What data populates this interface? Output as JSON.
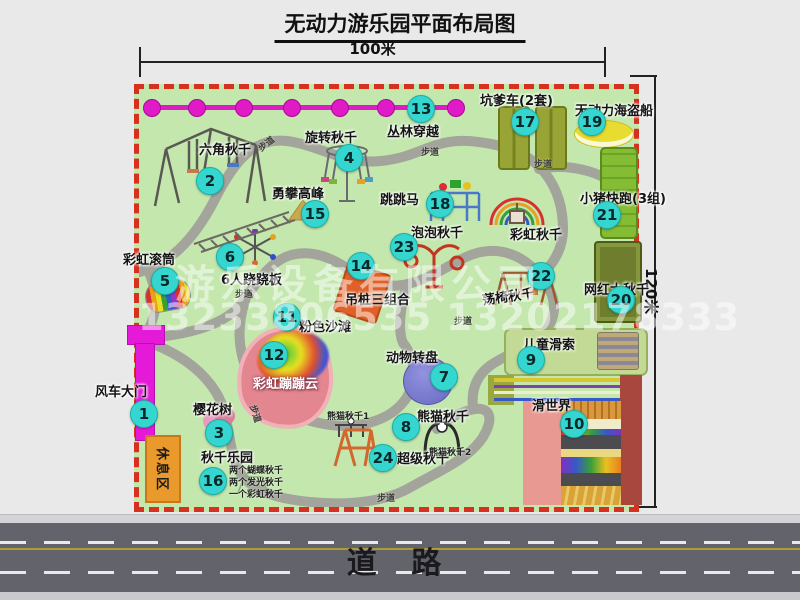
{
  "title": "无动力游乐园平面布局图",
  "dimensions": {
    "width_label": "100米",
    "height_label": "120米"
  },
  "road": {
    "label": "道  路"
  },
  "watermark": {
    "company": "游乐设备有限公司",
    "phone": "13233806535 13202178333"
  },
  "map": {
    "path_label": "步道",
    "rest_area_label": "休息区",
    "rainbow_swing_label": "彩虹秋千",
    "panda_swing_1": "熊猫秋千1",
    "panda_swing_2": "熊猫秋千2",
    "swing_park_details": [
      "两个蝴蝶秋千",
      "两个发光秋千",
      "一个彩虹秋千"
    ],
    "attractions": [
      {
        "num": "1",
        "label": "风车大门"
      },
      {
        "num": "2",
        "label": "六角秋千"
      },
      {
        "num": "3",
        "label": "樱花树"
      },
      {
        "num": "4",
        "label": "旋转秋千"
      },
      {
        "num": "5",
        "label": "彩虹滚筒"
      },
      {
        "num": "6",
        "label": "6人跷跷板"
      },
      {
        "num": "7",
        "label": "动物转盘"
      },
      {
        "num": "8",
        "label": "熊猫秋千"
      },
      {
        "num": "9",
        "label": "儿童滑索"
      },
      {
        "num": "10",
        "label": "滑世界"
      },
      {
        "num": "11",
        "label": "粉色沙滩"
      },
      {
        "num": "12",
        "label": "彩虹蹦蹦云"
      },
      {
        "num": "13",
        "label": "丛林穿越"
      },
      {
        "num": "14",
        "label": "吊桩三组合"
      },
      {
        "num": "15",
        "label": "勇攀高峰"
      },
      {
        "num": "16",
        "label": "秋千乐园"
      },
      {
        "num": "17",
        "label": "坑爹车(2套)"
      },
      {
        "num": "18",
        "label": "跳跳马"
      },
      {
        "num": "19",
        "label": "无动力海盗船"
      },
      {
        "num": "20",
        "label": "网红大秋千"
      },
      {
        "num": "21",
        "label": "小猪快跑(3组)"
      },
      {
        "num": "22",
        "label": "荡椅秋千"
      },
      {
        "num": "23",
        "label": "泡泡秋千"
      },
      {
        "num": "24",
        "label": "超级秋千"
      }
    ],
    "colors": {
      "marker": "#35d6cf",
      "border_dashed": "#d8301e",
      "map_bg": "#c3e7ad",
      "gate_magenta": "#e41ad8",
      "zipline_magenta": "#dc1cc4",
      "road_gray": "#63636b"
    }
  }
}
